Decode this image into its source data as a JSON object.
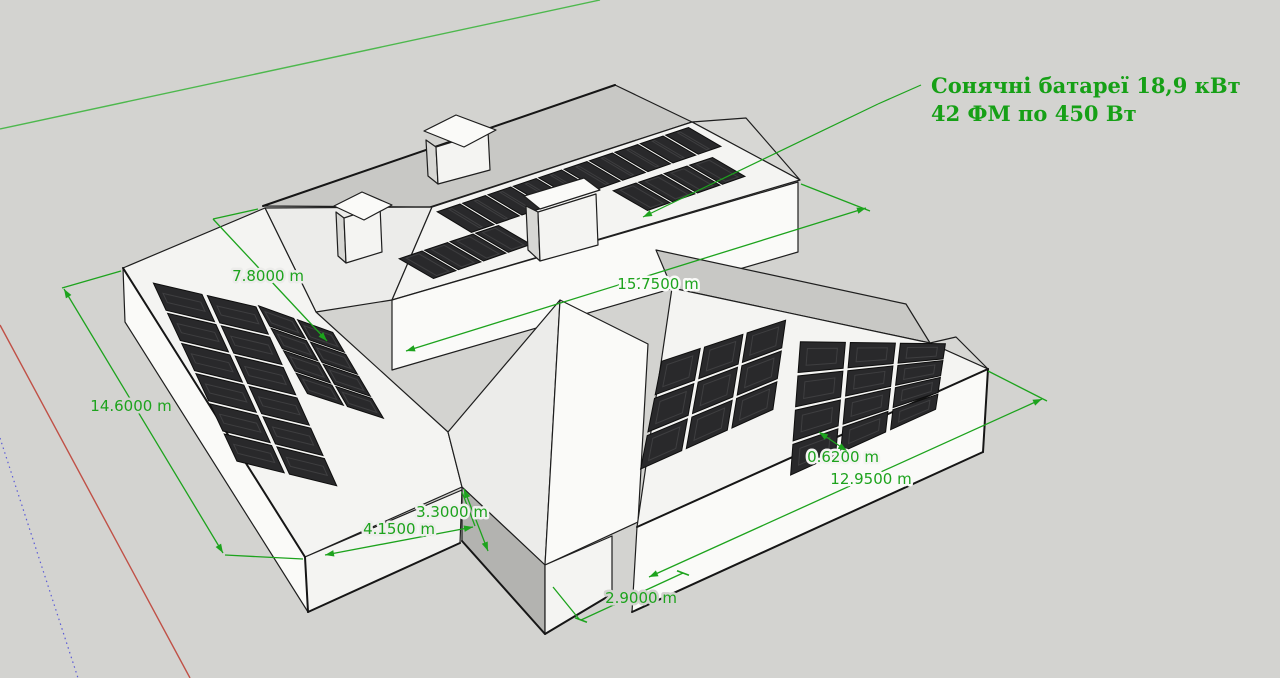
{
  "annotation": {
    "line1": "Сонячні батареї 18,9 кВт",
    "line2": "42 ФМ по 450 Вт"
  },
  "dimensions": {
    "roof_width_left": "7.8000 m",
    "house_side_left": "14.6000 m",
    "main_roof_length": "15.7500 m",
    "front_offset": "4.1500 m",
    "porch_side": "3.3000 m",
    "array_gap": "0.6200 m",
    "right_wing_length": "12.9500 m",
    "wing_gap": "2.9000 m"
  },
  "colors": {
    "background": "#d3d3d0",
    "dimension_green": "#1da31d",
    "annotation_green": "#16a016",
    "axis_green": "#4db84d",
    "axis_red": "#c05046",
    "axis_blue": "#5b5bd6",
    "panel": "#29292b",
    "panel_edge": "#0e0e0e",
    "house_edge": "#1e1e1e"
  }
}
